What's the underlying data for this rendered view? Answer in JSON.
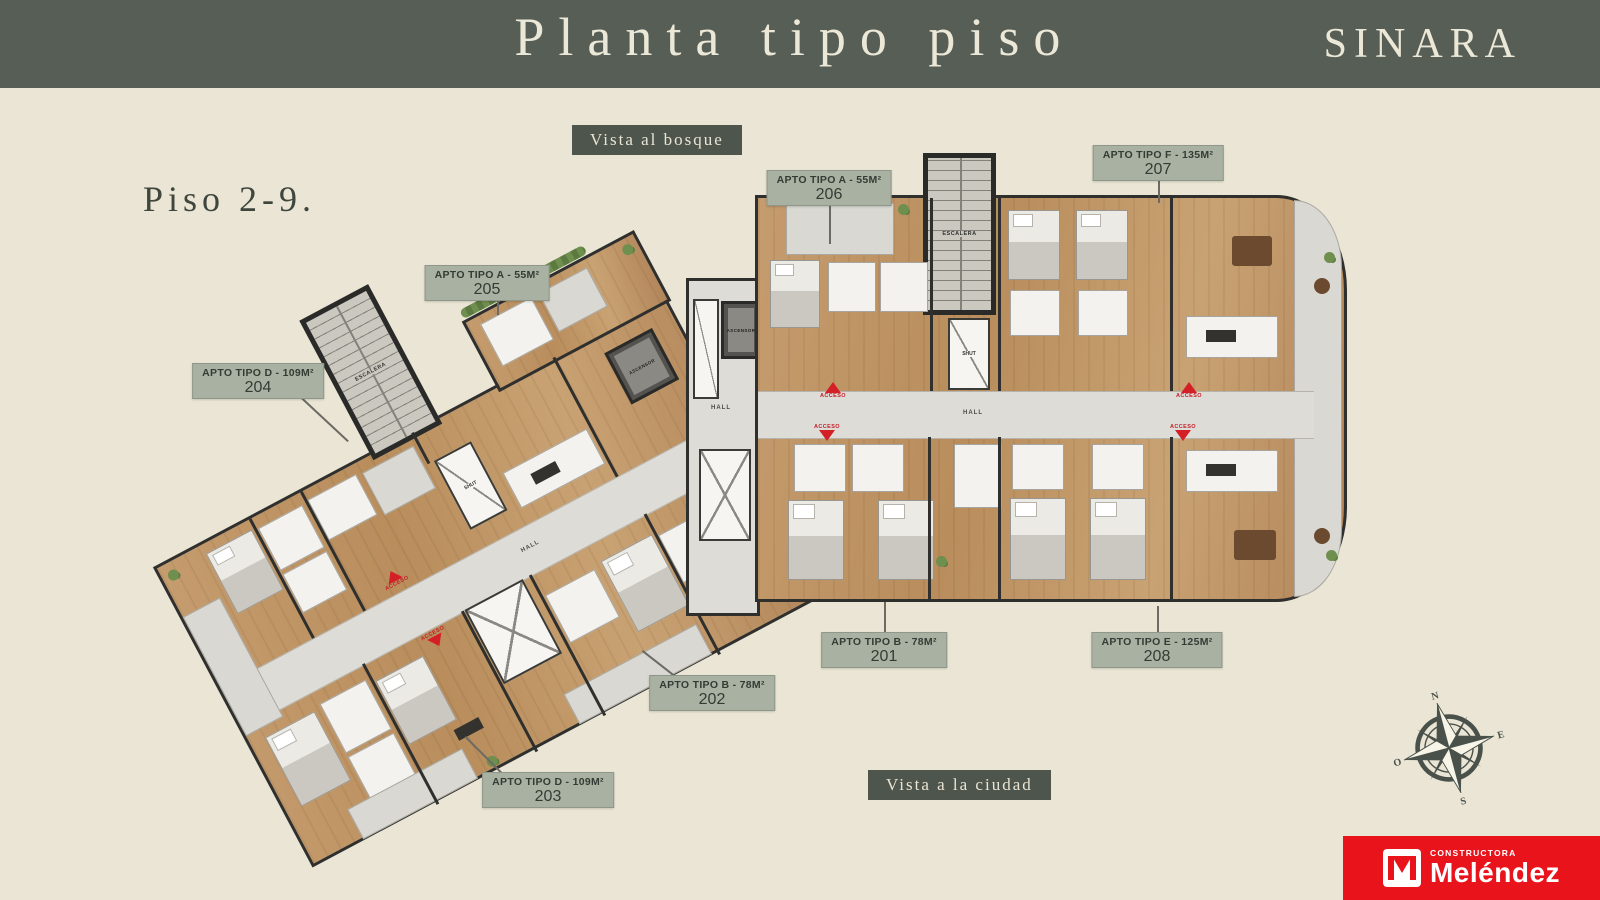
{
  "header": {
    "title": "Planta tipo piso",
    "brand": "SINARA"
  },
  "floor_label": "Piso 2-9.",
  "views": {
    "top": "Vista al bosque",
    "bottom": "Vista a la ciudad"
  },
  "apartments": [
    {
      "type": "APTO TIPO B - 78M²",
      "number": "201"
    },
    {
      "type": "APTO TIPO B - 78M²",
      "number": "202"
    },
    {
      "type": "APTO TIPO D - 109M²",
      "number": "203"
    },
    {
      "type": "APTO TIPO D - 109M²",
      "number": "204"
    },
    {
      "type": "APTO TIPO A - 55M²",
      "number": "205"
    },
    {
      "type": "APTO TIPO A - 55M²",
      "number": "206"
    },
    {
      "type": "APTO TIPO F - 135M²",
      "number": "207"
    },
    {
      "type": "APTO TIPO E - 125M²",
      "number": "208"
    }
  ],
  "plan_labels": {
    "stairs": "ESCALERA",
    "elevator": "ASCENSOR",
    "hall": "HALL",
    "chute": "SHUT",
    "access": "ACCESO"
  },
  "compass": {
    "north": "N",
    "east": "E",
    "south": "S",
    "west": "O"
  },
  "logo": {
    "line1": "CONSTRUCTORA",
    "line2": "Meléndez"
  },
  "colors": {
    "header": "#565E55",
    "background": "#EAE5D4",
    "badge": "#A9B1A2",
    "dark_badge": "#4D554C",
    "wood": "#BF9263",
    "accent_red": "#D41F26",
    "logo_red": "#E9131B"
  }
}
